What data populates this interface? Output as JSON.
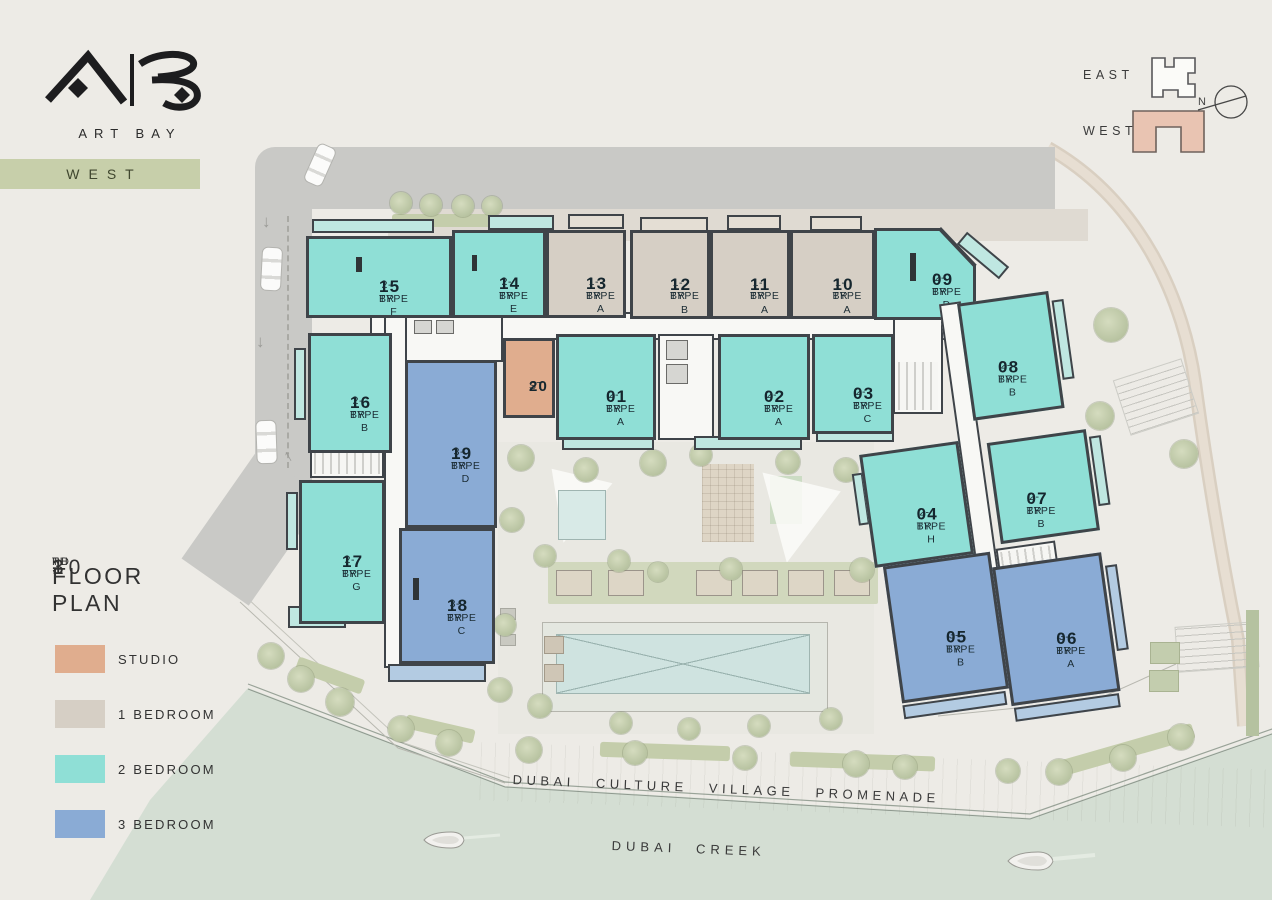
{
  "brand": {
    "monogram": "AB",
    "name": "ART BAY",
    "badge": "WEST"
  },
  "minimap": {
    "east_label": "EAST",
    "west_label": "WEST",
    "compass_n": "N"
  },
  "plan_title": {
    "floor_range": "3RD - 10TH",
    "parts": {
      "start_num": "3",
      "start_sup": "RD",
      "dash": "-",
      "end_num": "10",
      "end_sup": "TH"
    },
    "subtitle": "FLOOR PLAN"
  },
  "legend": {
    "items": [
      {
        "id": "studio",
        "label": "STUDIO",
        "color": "#e0ad8e"
      },
      {
        "id": "br1",
        "label": "1 BEDROOM",
        "color": "#d6cfc5"
      },
      {
        "id": "br2",
        "label": "2 BEDROOM",
        "color": "#8fdfd6"
      },
      {
        "id": "br3",
        "label": "3 BEDROOM",
        "color": "#8aabd5"
      }
    ]
  },
  "units": {
    "u01": {
      "number": "01",
      "l1": "2-BR",
      "l2": "TYPE A",
      "cat": "br2"
    },
    "u02": {
      "number": "02",
      "l1": "2-BR",
      "l2": "TYPE A",
      "cat": "br2"
    },
    "u03": {
      "number": "03",
      "l1": "2-BR",
      "l2": "TYPE C",
      "cat": "br2"
    },
    "u04": {
      "number": "04",
      "l1": "2-BR",
      "l2": "TYPE H",
      "cat": "br2"
    },
    "u05": {
      "number": "05",
      "l1": "3-BR",
      "l2": "TYPE B",
      "cat": "br3"
    },
    "u06": {
      "number": "06",
      "l1": "3-BR",
      "l2": "TYPE A",
      "cat": "br3"
    },
    "u07": {
      "number": "07",
      "l1": "2-BR",
      "l2": "TYPE B",
      "cat": "br2"
    },
    "u08": {
      "number": "08",
      "l1": "2-BR",
      "l2": "TYPE B",
      "cat": "br2"
    },
    "u09": {
      "number": "09",
      "l1": "2-BR",
      "l2": "TYPE D",
      "cat": "br2"
    },
    "u10": {
      "number": "10",
      "l1": "1-BR",
      "l2": "TYPE A",
      "cat": "br1"
    },
    "u11": {
      "number": "11",
      "l1": "1-BR",
      "l2": "TYPE A",
      "cat": "br1"
    },
    "u12": {
      "number": "12",
      "l1": "1-BR",
      "l2": "TYPE B",
      "cat": "br1"
    },
    "u13": {
      "number": "13",
      "l1": "1-BR",
      "l2": "TYPE A",
      "cat": "br1"
    },
    "u14": {
      "number": "14",
      "l1": "2-BR",
      "l2": "TYPE E",
      "cat": "br2"
    },
    "u15": {
      "number": "15",
      "l1": "2-BR",
      "l2": "TYPE F",
      "cat": "br2"
    },
    "u16": {
      "number": "16",
      "l1": "2-BR",
      "l2": "TYPE B",
      "cat": "br2"
    },
    "u17": {
      "number": "17",
      "l1": "2-BR",
      "l2": "TYPE G",
      "cat": "br2"
    },
    "u18": {
      "number": "18",
      "l1": "3-BR",
      "l2": "TYPE C",
      "cat": "br3"
    },
    "u19": {
      "number": "19",
      "l1": "3-BR",
      "l2": "TYPE D",
      "cat": "br3"
    },
    "u20": {
      "number": "20",
      "l1": "ST",
      "l2": "",
      "cat": "studio"
    }
  },
  "map_labels": {
    "promenade": "DUBAI CULTURE VILLAGE PROMENADE",
    "creek": "DUBAI CREEK"
  }
}
